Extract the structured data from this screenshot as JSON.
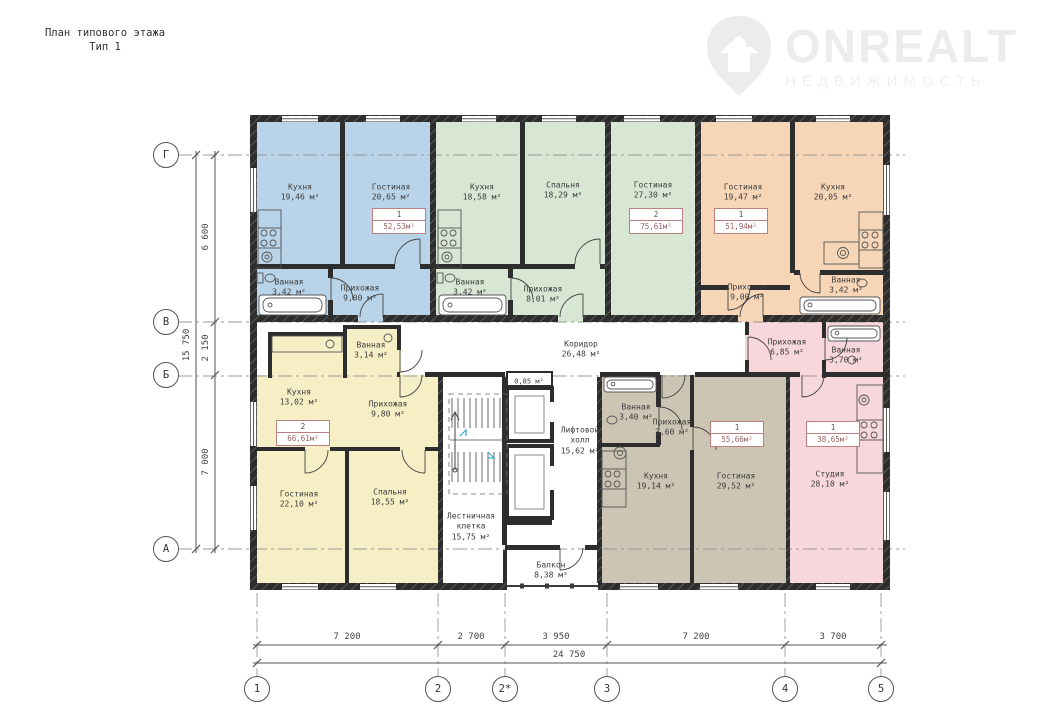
{
  "title": {
    "line1": "План типового этажа",
    "line2": "Тип 1"
  },
  "watermark": {
    "brand": "ONREALT",
    "subtitle": "НЕДВИЖИМОСТЬ"
  },
  "axes": {
    "rows": [
      "Г",
      "В",
      "Б",
      "А"
    ],
    "cols": [
      "1",
      "2",
      "2*",
      "3",
      "4",
      "5"
    ]
  },
  "dimensions": {
    "left": [
      "6 600",
      "2 150",
      "7 000"
    ],
    "left_total": "15 750",
    "bottom": [
      "7 200",
      "2 700",
      "3 950",
      "7 200",
      "3 700"
    ],
    "bottom_total": "24 750"
  },
  "colors": {
    "blue": "#b9d4e9",
    "green": "#d7e7d3",
    "orange": "#f6d6b6",
    "yellow": "#f6eec5",
    "brown": "#ccc5b3",
    "pink": "#f7d7db",
    "wall": "#2d2d2d",
    "badge_border": "#bb8080"
  },
  "apartments": {
    "blue": {
      "badge": {
        "num": "1",
        "area": "52,53м²"
      },
      "rooms": {
        "kitchen": {
          "name": "Кухня",
          "area": "19,46 м²"
        },
        "living": {
          "name": "Гостиная",
          "area": "20,65 м²"
        },
        "bath": {
          "name": "Ванная",
          "area": "3,42 м²"
        },
        "hall": {
          "name": "Прихожая",
          "area": "9,00 м²"
        }
      }
    },
    "green": {
      "badge": {
        "num": "2",
        "area": "75,61м²"
      },
      "rooms": {
        "kitchen": {
          "name": "Кухня",
          "area": "18,58 м²"
        },
        "bedroom": {
          "name": "Спальня",
          "area": "18,29 м²"
        },
        "living": {
          "name": "Гостиная",
          "area": "27,30 м²"
        },
        "bath": {
          "name": "Ванная",
          "area": "3,42 м²"
        },
        "hall": {
          "name": "Прихожая",
          "area": "8,01 м²"
        }
      }
    },
    "orange": {
      "badge": {
        "num": "1",
        "area": "51,94м²"
      },
      "rooms": {
        "living": {
          "name": "Гостиная",
          "area": "19,47 м²"
        },
        "kitchen": {
          "name": "Кухня",
          "area": "20,05 м²"
        },
        "hall": {
          "name": "Прихожая",
          "area": "9,00 м²"
        },
        "bath": {
          "name": "Ванная",
          "area": "3,42 м²"
        }
      }
    },
    "yellow": {
      "badge": {
        "num": "2",
        "area": "66,61м²"
      },
      "rooms": {
        "bath": {
          "name": "Ванная",
          "area": "3,14 м²"
        },
        "kitchen": {
          "name": "Кухня",
          "area": "13,02 м²"
        },
        "hall": {
          "name": "Прихожая",
          "area": "9,80 м²"
        },
        "living": {
          "name": "Гостиная",
          "area": "22,10 м²"
        },
        "bedroom": {
          "name": "Спальня",
          "area": "18,55 м²"
        }
      }
    },
    "brown": {
      "badge": {
        "num": "1",
        "area": "55,66м²"
      },
      "rooms": {
        "bath": {
          "name": "Ванная",
          "area": "3,40 м²"
        },
        "hall": {
          "name": "Прихожая",
          "area": "3,60 м²"
        },
        "kitchen": {
          "name": "Кухня",
          "area": "19,14 м²"
        },
        "living": {
          "name": "Гостиная",
          "area": "29,52 м²"
        }
      }
    },
    "pink": {
      "badge": {
        "num": "1",
        "area": "38,65м²"
      },
      "rooms": {
        "hall": {
          "name": "Прихожая",
          "area": "6,85 м²"
        },
        "bath": {
          "name": "Ванная",
          "area": "3,70 м²"
        },
        "studio": {
          "name": "Студия",
          "area": "28,10 м²"
        }
      }
    }
  },
  "core": {
    "corridor": {
      "name": "Коридор",
      "area": "26,48 м²"
    },
    "shaft": {
      "area": "0,85 м²"
    },
    "lift_hall": {
      "name": "Лифтовой холл",
      "area": "15,62 м²"
    },
    "stairwell": {
      "name": "Лестничная клетка",
      "area": "15,75 м²"
    },
    "balcony": {
      "name": "Балкон",
      "area": "8,38 м²"
    }
  }
}
